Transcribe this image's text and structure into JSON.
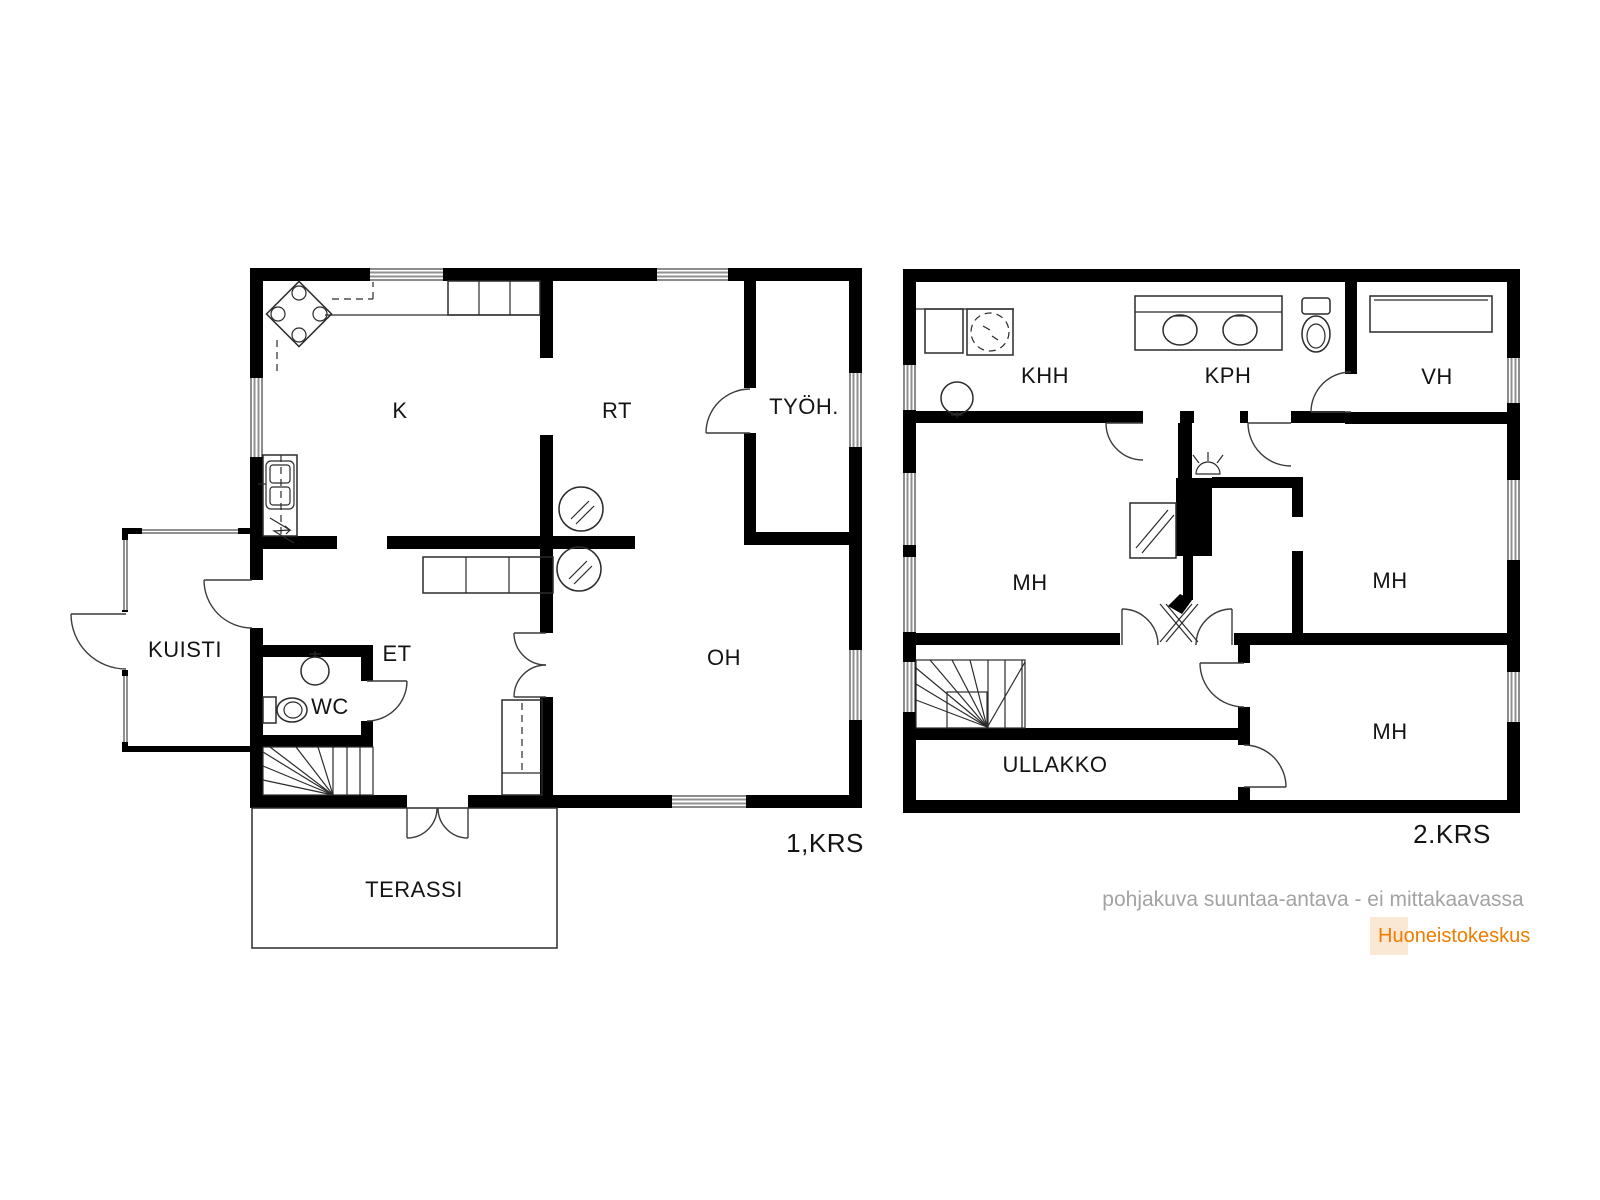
{
  "floor1": {
    "floor_label": "1,KRS",
    "rooms": [
      {
        "key": "k",
        "label": "K"
      },
      {
        "key": "rt",
        "label": "RT"
      },
      {
        "key": "tyoh",
        "label": "TYÖH."
      },
      {
        "key": "kuisti",
        "label": "KUISTI"
      },
      {
        "key": "et",
        "label": "ET"
      },
      {
        "key": "wc",
        "label": "WC"
      },
      {
        "key": "oh",
        "label": "OH"
      },
      {
        "key": "terassi",
        "label": "TERASSI"
      }
    ]
  },
  "floor2": {
    "floor_label": "2.KRS",
    "rooms": [
      {
        "key": "khh",
        "label": "KHH"
      },
      {
        "key": "kph",
        "label": "KPH"
      },
      {
        "key": "vh",
        "label": "VH"
      },
      {
        "key": "mh_left",
        "label": "MH"
      },
      {
        "key": "mh_right",
        "label": "MH"
      },
      {
        "key": "mh_bottom",
        "label": "MH"
      },
      {
        "key": "ullakko",
        "label": "ULLAKKO"
      }
    ]
  },
  "footer": {
    "disclaimer": "pohjakuva suuntaa-antava - ei mittakaavassa",
    "brand": "Huoneistokeskus"
  },
  "colors": {
    "wall": "#000000",
    "line": "#2b2b2b",
    "window": "#909090",
    "disclaimer_text": "#a3a3a3",
    "brand_text": "#ef7d00",
    "brand_bg": "#fbe8d4",
    "background": "#ffffff"
  }
}
